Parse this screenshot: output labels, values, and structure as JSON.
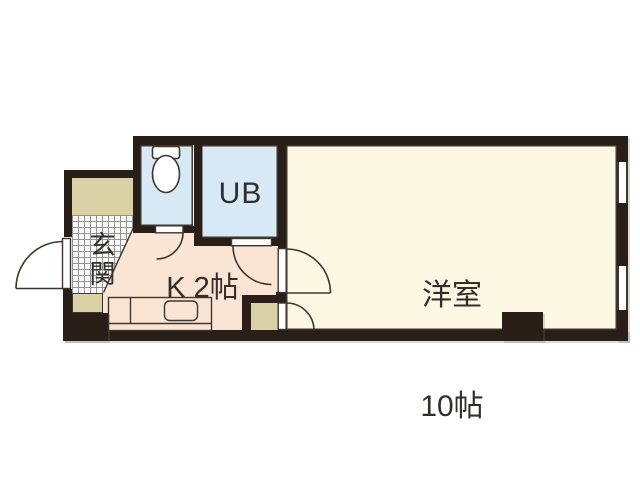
{
  "floorplan": {
    "rooms": {
      "entrance": {
        "label": "玄関"
      },
      "kitchen": {
        "label": "K 2帖"
      },
      "unit_bath": {
        "label": "UB"
      },
      "western_room": {
        "name": "洋室",
        "size": "10帖"
      }
    },
    "icons": {
      "toilet": "toilet-icon",
      "sink": "kitchen-sink-icon"
    },
    "colors": {
      "wall": "#2a1f18",
      "room-floor": "#fcf8e3",
      "kitchen-floor": "#fae4d4",
      "wet-floor": "#d6e9f4",
      "step-floor": "#dbd1a6",
      "line": "#3c362f"
    }
  }
}
